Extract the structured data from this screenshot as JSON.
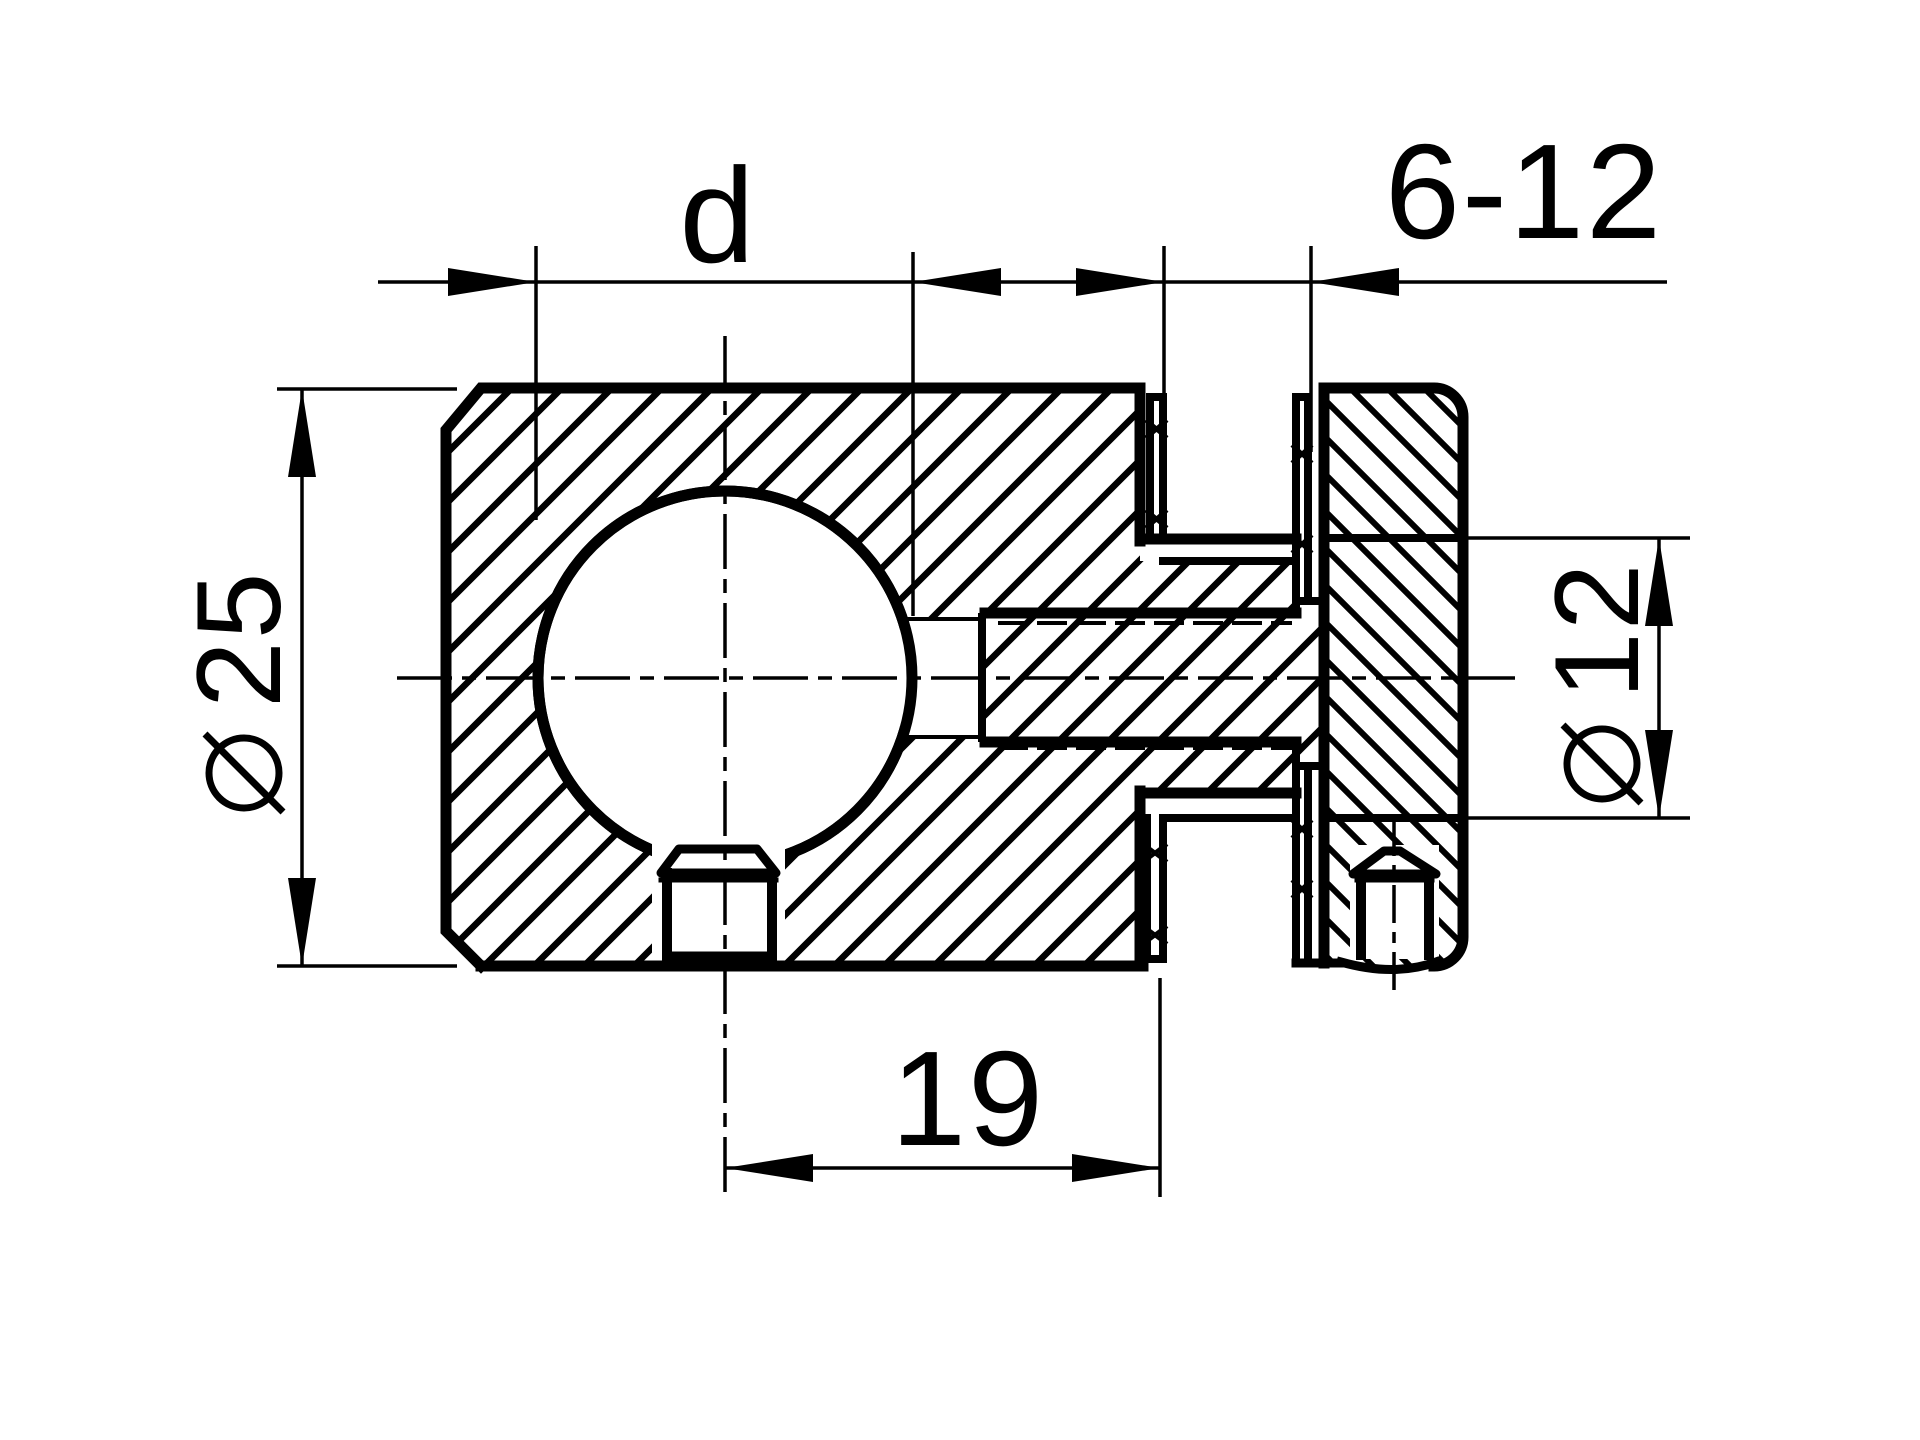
{
  "drawing": {
    "type": "technical-section-drawing",
    "description": "Sectional view of a cross connector clamp: left block with large bore d and bottom hex set screw, threaded center stud, right clamping jaw with vertical hex set screw",
    "background_color": "#ffffff",
    "ink_color": "#000000",
    "dimensions": {
      "bore_d": {
        "label": "d",
        "kind": "width",
        "position": "top-left"
      },
      "clamp_range": {
        "label": "6-12",
        "kind": "width",
        "position": "top-right"
      },
      "body_diameter": {
        "symbol": "⌀",
        "value": "25",
        "kind": "diameter",
        "position": "left",
        "orientation": "rotated-90"
      },
      "rod_diameter": {
        "symbol": "⌀",
        "value": "12",
        "kind": "diameter",
        "position": "right",
        "orientation": "rotated-90"
      },
      "center_offset": {
        "label": "19",
        "kind": "width",
        "position": "bottom"
      }
    }
  }
}
